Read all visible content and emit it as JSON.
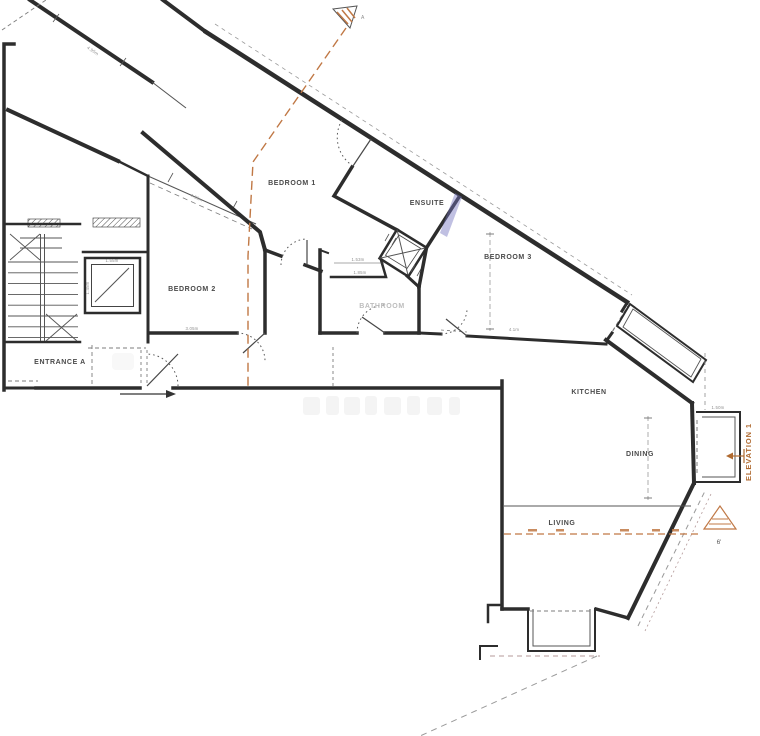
{
  "document": {
    "type": "architectural floor plan (scanned)",
    "rooms": [
      {
        "label": "BEDROOM 1"
      },
      {
        "label": "BEDROOM 2"
      },
      {
        "label": "BEDROOM 3"
      },
      {
        "label": "ENSUITE"
      },
      {
        "label": "BATHROOM"
      },
      {
        "label": "ENTRANCE A"
      },
      {
        "label": "KITCHEN"
      },
      {
        "label": "DINING"
      },
      {
        "label": "LIVING"
      }
    ],
    "annotations": {
      "elevation_label": "ELEVATION 1",
      "section_letter": "A",
      "height_note": "6'"
    },
    "dimensions": [
      {
        "text": "4.95m"
      },
      {
        "text": "4.95m"
      },
      {
        "text": "1.55m"
      },
      {
        "text": "1.45m"
      },
      {
        "text": "1.53m"
      },
      {
        "text": "1.85m"
      },
      {
        "text": "3.05m"
      },
      {
        "text": "4.1m"
      },
      {
        "text": "1.50m"
      }
    ],
    "watermark": {
      "visible": true,
      "legible": false
    },
    "colors": {
      "wall": "#2d2d2d",
      "section_line": "#c07845",
      "elevation_text": "#b06a30",
      "dim_text": "#8f8f8f",
      "faint_label": "#bdbdbd"
    }
  }
}
